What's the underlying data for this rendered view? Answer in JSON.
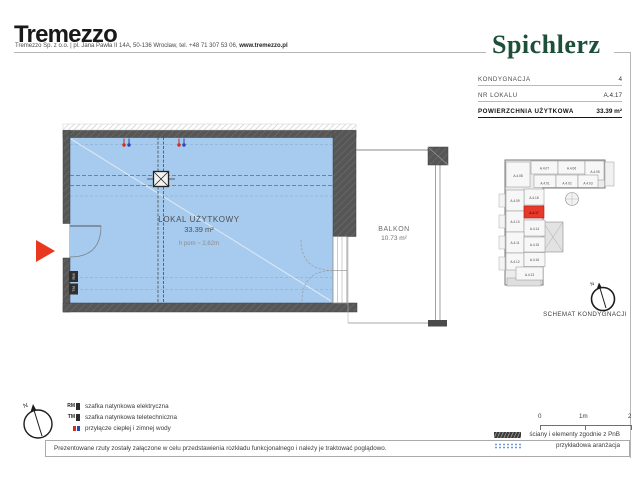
{
  "header": {
    "developer_name": "Tremezzo",
    "developer_info": "Tremezzo Sp. z o.o. | pl. Jana Pawła II 14A, 50-136 Wrocław, tel. +48 71 307 53 06, ",
    "developer_site": "www.tremezzo.pl",
    "project_name": "Spichlerz",
    "brand_color": "#1d4f3a"
  },
  "info_table": {
    "rows": [
      {
        "label": "KONDYGNACJA",
        "value": "4"
      },
      {
        "label": "NR LOKALU",
        "value": "A.4.17"
      },
      {
        "label": "POWIERZCHNIA UŻYTKOWA",
        "value": "33.39 m²"
      }
    ]
  },
  "plan": {
    "room_name": "LOKAL UŻYTKOWY",
    "room_area": "33.39 m²",
    "room_height": "h pom ~ 2,62m",
    "balcony_name": "BALKON",
    "balcony_area": "10.73 m²",
    "cabinets": {
      "electric": "RM",
      "tele": "TM"
    },
    "colors": {
      "room_fill": "#a6cbee",
      "wall": "#565656",
      "entrance_arrow": "#e8391f",
      "water_red": "#d92b1a",
      "water_blue": "#2847b8"
    }
  },
  "schematic": {
    "caption": "SCHEMAT KONDYGNACJI",
    "highlight_unit": "A.4.17",
    "highlight_color": "#e8382c",
    "units": [
      {
        "label": "A.4.07"
      },
      {
        "label": "A.4.06"
      },
      {
        "label": "A.4.05"
      },
      {
        "label": "A.4.08"
      },
      {
        "label": "A.4.01"
      },
      {
        "label": "A.4.02"
      },
      {
        "label": "A.4.03"
      },
      {
        "label": "A.4.18"
      },
      {
        "label": "A.4.09"
      },
      {
        "label": "A.4.17"
      },
      {
        "label": "A.4.10"
      },
      {
        "label": "A.4.14"
      },
      {
        "label": "A.4.11"
      },
      {
        "label": "A.4.15"
      },
      {
        "label": "A.4.12"
      },
      {
        "label": "A.4.16"
      },
      {
        "label": "A.4.13"
      }
    ]
  },
  "compass": {
    "north_label": "N"
  },
  "legend_left": {
    "items": [
      {
        "icon": "RM",
        "label": "szafka natynkowa elektryczna"
      },
      {
        "icon": "TM",
        "label": "szafka natynkowa teletechniczna"
      },
      {
        "icon": "water",
        "label": "przyłącze ciepłej i zimnej wody"
      }
    ]
  },
  "scale_bar": {
    "ticks": [
      "0",
      "1m",
      "2"
    ]
  },
  "legend_right": {
    "items": [
      {
        "label": "ściany i elementy zgodnie z PnB"
      },
      {
        "label": "przykładowa aranżacja"
      }
    ]
  },
  "footer": {
    "disclaimer": "Prezentowane rzuty zostały załączone w celu przedstawienia rozkładu funkcjonalnego i należy je traktować poglądowo."
  }
}
